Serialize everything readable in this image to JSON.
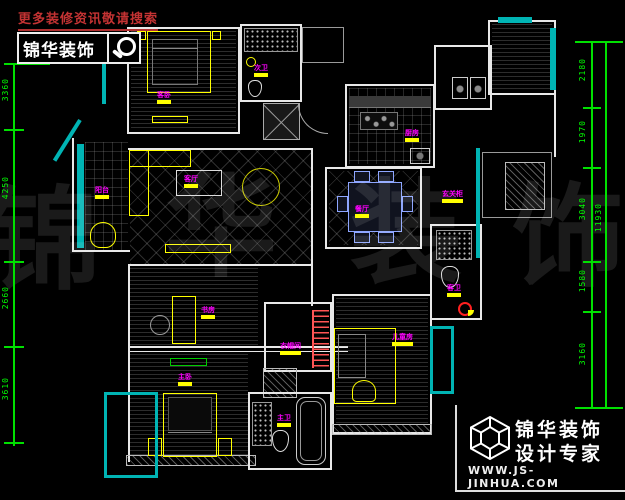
{
  "header": {
    "promo_text": "更多装修资讯敬请搜索",
    "brand": "锦华装饰"
  },
  "watermark": {
    "chars": [
      "锦",
      "华",
      "装",
      "饰"
    ]
  },
  "rooms": [
    {
      "id": "guest-bedroom",
      "label": "客卧"
    },
    {
      "id": "second-bath",
      "label": "次卫"
    },
    {
      "id": "kitchen",
      "label": "厨房"
    },
    {
      "id": "balcony",
      "label": "阳台"
    },
    {
      "id": "living-room",
      "label": "客厅"
    },
    {
      "id": "dining-room",
      "label": "餐厅"
    },
    {
      "id": "hall-cabinet",
      "label": "玄关柜"
    },
    {
      "id": "study",
      "label": "书房"
    },
    {
      "id": "master-bedroom",
      "label": "主卧"
    },
    {
      "id": "cloakroom",
      "label": "衣帽间"
    },
    {
      "id": "master-bath",
      "label": "主卫"
    },
    {
      "id": "kids-room",
      "label": "儿童房"
    },
    {
      "id": "guest-bath",
      "label": "客卫"
    }
  ],
  "dimensions": {
    "left": [
      "3360",
      "4250",
      "2660",
      "3610"
    ],
    "right_segments": [
      "2180",
      "1970",
      "3040",
      "1580",
      "3160"
    ],
    "right_total": "11930"
  },
  "footer": {
    "brand_line1": "锦华装饰",
    "brand_line2": "设计专家",
    "website": "WWW.JS-JINHUA.COM"
  },
  "colors": {
    "dimension_green": "#00ff00",
    "label_magenta": "#ff00ff",
    "highlight_yellow": "#ffff00",
    "window_teal": "#00b4b4",
    "promo_red": "#c43333"
  }
}
